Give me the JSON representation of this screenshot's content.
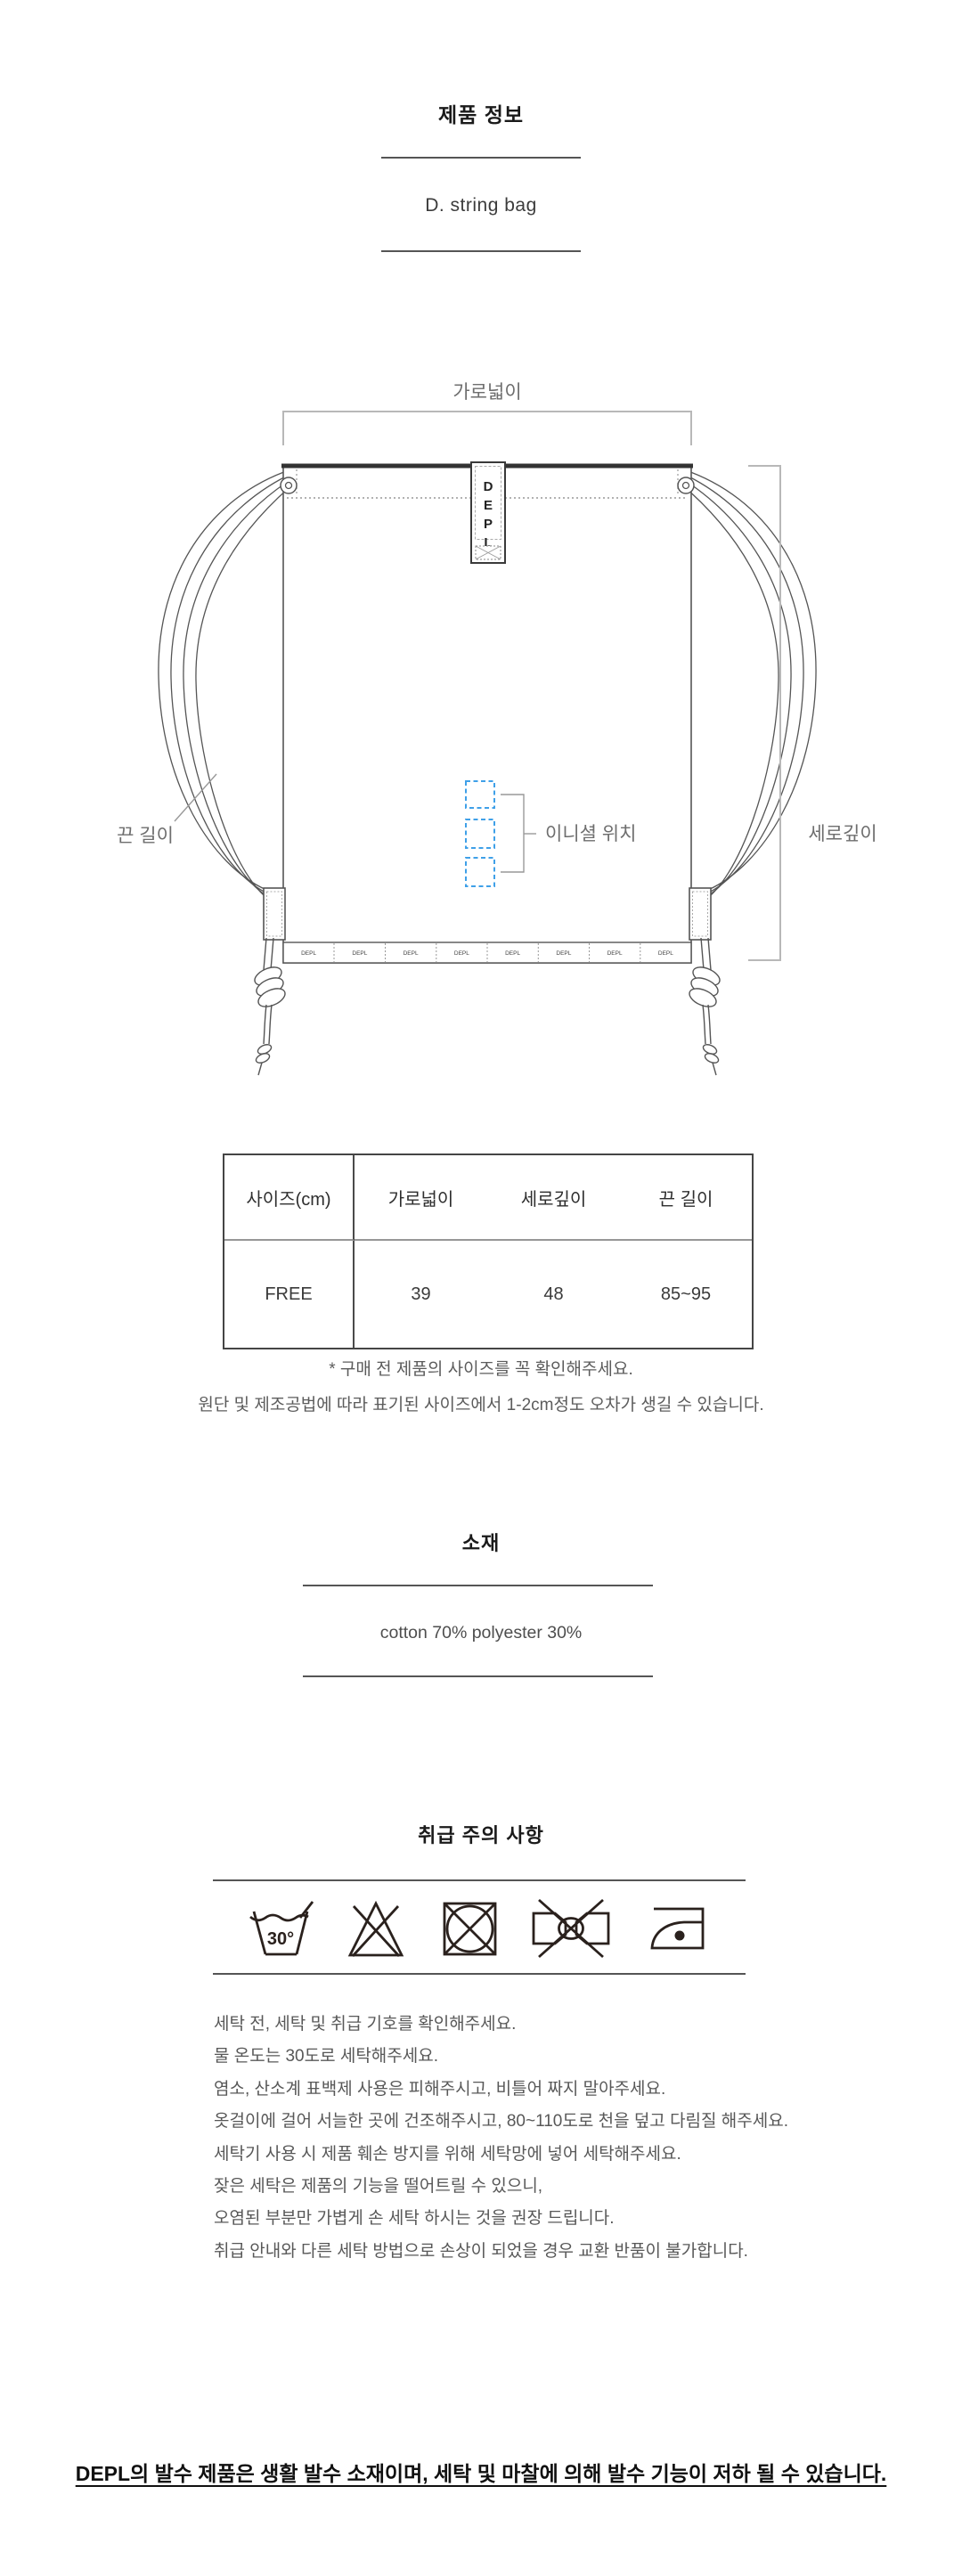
{
  "header": {
    "title": "제품 정보",
    "subtitle": "D. string bag"
  },
  "diagram": {
    "width_label": "가로넓이",
    "strap_label": "끈 길이",
    "depth_label": "세로깊이",
    "initial_label": "이니셜 위치",
    "tag_letters": [
      "D",
      "E",
      "P",
      "L"
    ],
    "bottom_strip_logo": "DEPL",
    "accent_blue": "#3fa0e8"
  },
  "size_table": {
    "headers": [
      "사이즈(cm)",
      "가로넓이",
      "세로깊이",
      "끈 길이"
    ],
    "row": {
      "size": "FREE",
      "width": "39",
      "depth": "48",
      "strap": "85~95"
    }
  },
  "size_note": {
    "line1": "* 구매 전 제품의 사이즈를 꼭 확인해주세요.",
    "line2": "원단 및 제조공법에 따라 표기된 사이즈에서 1-2cm정도 오차가 생길 수 있습니다."
  },
  "material": {
    "title": "소재",
    "content": "cotton 70% polyester 30%"
  },
  "care": {
    "title": "취급 주의 사항",
    "wash_temp_label": "30°",
    "instructions": [
      "세탁 전, 세탁 및 취급 기호를 확인해주세요.",
      "물 온도는 30도로 세탁해주세요.",
      "염소, 산소계 표백제 사용은 피해주시고, 비틀어 짜지 말아주세요.",
      "옷걸이에 걸어 서늘한 곳에 건조해주시고, 80~110도로 천을 덮고 다림질 해주세요.",
      "세탁기 사용 시 제품 훼손 방지를 위해 세탁망에 넣어 세탁해주세요.",
      "잦은 세탁은 제품의 기능을 떨어트릴 수 있으니,",
      "오염된 부분만 가볍게 손 세탁 하시는 것을 권장 드립니다.",
      "취급 안내와 다른 세탁 방법으로 손상이 되었을 경우 교환 반품이 불가합니다."
    ]
  },
  "footer": {
    "text": "DEPL의 발수 제품은 생활 발수 소재이며, 세탁 및 마찰에 의해 발수 기능이 저하 될 수 있습니다."
  }
}
